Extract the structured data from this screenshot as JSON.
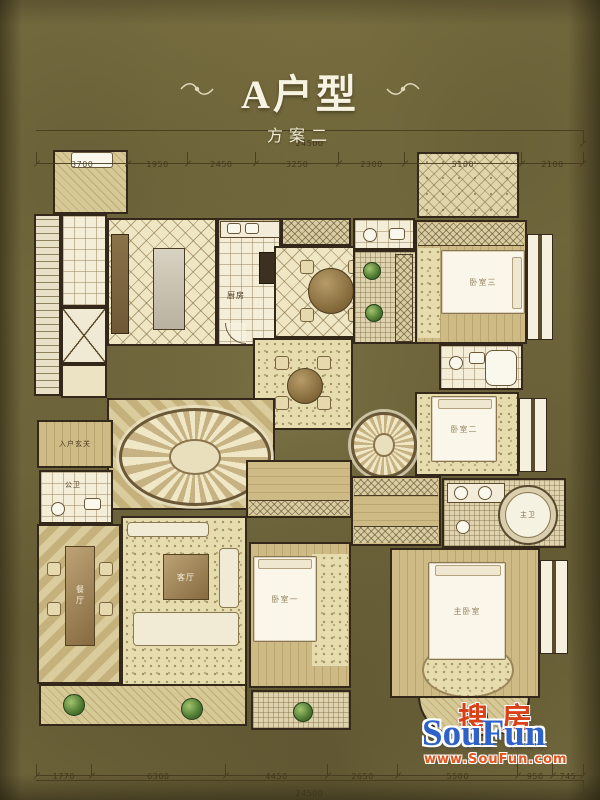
{
  "header": {
    "title": "A户型",
    "subtitle": "方案二"
  },
  "dimensions": {
    "top": {
      "total": "24500",
      "segments": [
        "3700",
        "1950",
        "2450",
        "3250",
        "2300",
        "5100",
        "2100"
      ]
    },
    "bottom": {
      "total": "24500",
      "segments": [
        "1770",
        "6300",
        "4450",
        "2650",
        "5500",
        "950",
        "745"
      ]
    }
  },
  "rooms": {
    "entry_foyer": {
      "label": "入户玄关"
    },
    "guest_bath": {
      "label": "公卫"
    },
    "dining": {
      "label": "餐厅"
    },
    "living": {
      "label": "客厅"
    },
    "kitchen": {
      "label": "厨房"
    },
    "bedroom1": {
      "label": "卧室一"
    },
    "bedroom2": {
      "label": "卧室二"
    },
    "bedroom3": {
      "label": "卧室三"
    },
    "master_bedroom": {
      "label": "主卧室"
    },
    "master_bath": {
      "label": "主卫"
    }
  },
  "watermark": {
    "cn": "搜房",
    "en": "SouFun",
    "url": "www.SouFun.com",
    "colors": {
      "cn": "#d94118",
      "en": "#2f62c8",
      "url": "#e2551c"
    }
  }
}
